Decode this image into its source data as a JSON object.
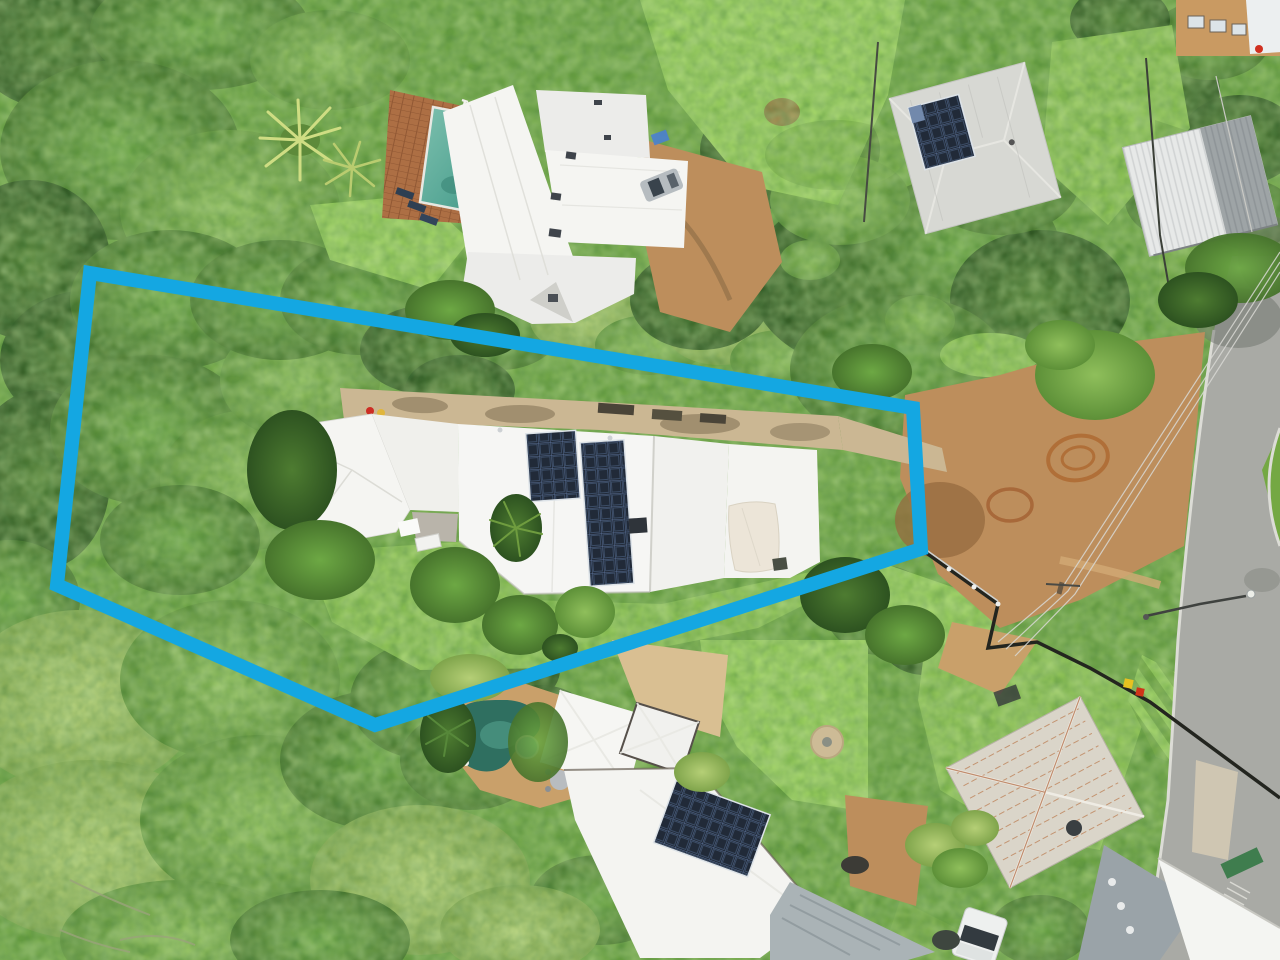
{
  "image": {
    "kind": "aerial-drone-photograph",
    "description": "Top-down aerial photo of a suburban bush block; a long irregular lot outlined with a thick blue boundary highlight contains a white-roofed house with rooftop solar, a concrete driveway and lawn surrounded by dense tree canopy; neighbouring houses with pools, solar panels, a rusty-roofed cottage, a curving street, power lines and cleared red-dirt ground are visible.",
    "width_px": 1280,
    "height_px": 960,
    "visible_text": ""
  },
  "boundary": {
    "points": "90,273 913,408 921,549 375,725 57,585",
    "color": "#14a7e2",
    "stroke_width": 14
  },
  "palette": {
    "boundary": "#14a7e2",
    "canopy_base": "#69a03f",
    "canopy_dark": "#3c6527",
    "canopy_mid": "#5d9038",
    "canopy_light": "#8fbf5b",
    "canopy_yellow": "#a9c86d",
    "lawn": "#8cc152",
    "lawn_bright": "#97cd5a",
    "lawn_dark": "#74a843",
    "roof_white": "#f5f5f2",
    "roof_weathered": "#d7d8d3",
    "roof_rust_base": "#dad5c9",
    "rust": "#b2602a",
    "solar_dark": "#212a38",
    "solar_light": "#51709f",
    "pool_top": "#5aa795",
    "pool_bottom": "#2f6f60",
    "spa": "#8ecbd6",
    "deck_brick": "#ad6f44",
    "paving_tan": "#c9a06a",
    "driveway": "#cbb793",
    "dirt": "#bd8e5c",
    "dirt_dark": "#96693f",
    "road": "#a9aaa5",
    "curb": "#dcdcd6",
    "fence_dark": "#23251f",
    "shade_sail": "#ece5d8",
    "vehicle_white": "#eef0ef",
    "vehicle_gray": "#b6bcc0"
  },
  "scene": {
    "objects": [
      {
        "name": "boundary-highlight",
        "label": "blue highlighted lot boundary polygon"
      },
      {
        "name": "subject-house",
        "label": "white-roofed house inside boundary with two rooftop solar arrays"
      },
      {
        "name": "subject-driveway",
        "label": "long concrete driveway along north side of lot"
      },
      {
        "name": "subject-backyard-lawn",
        "label": "lawn south of subject house"
      },
      {
        "name": "shade-sail",
        "label": "cream shade sail on east wing"
      },
      {
        "name": "neighbor-north-house",
        "label": "white multi-section roof house north of lot"
      },
      {
        "name": "neighbor-north-pool",
        "label": "teal rectangular swimming pool with brick deck"
      },
      {
        "name": "neighbor-northeast-house",
        "label": "weathered hip-roof house with solar panels"
      },
      {
        "name": "neighbor-northeast-carport",
        "label": "corrugated metal carport/shed"
      },
      {
        "name": "street-corner-building",
        "label": "tan building at top right corner"
      },
      {
        "name": "road",
        "label": "curving asphalt street on right"
      },
      {
        "name": "cleared-dirt-area",
        "label": "graded red-dirt clearing with circular marks"
      },
      {
        "name": "power-pole",
        "label": "timber power pole with crossarm"
      },
      {
        "name": "power-lines",
        "label": "overhead wires crossing the clearing"
      },
      {
        "name": "street-light",
        "label": "street light arm over road"
      },
      {
        "name": "boundary-fence",
        "label": "dark fence with white posts along south-east lot edge"
      },
      {
        "name": "neighbor-south-house",
        "label": "white pyramid-roof house with solar array and kidney pool"
      },
      {
        "name": "neighbor-south-pool",
        "label": "dark teal kidney-shaped pool with spa"
      },
      {
        "name": "neighbor-southeast-rusty-roof-house",
        "label": "silver cottage roof streaked with rust, satellite dish"
      },
      {
        "name": "white-ute",
        "label": "white utility vehicle parked at bottom right"
      },
      {
        "name": "tree-canopy",
        "label": "dense green tree canopy over left half of frame"
      },
      {
        "name": "palm-trees",
        "label": "fan palms near pools and gardens"
      },
      {
        "name": "mow-striped-verge",
        "label": "mow-striped grass verge beside road"
      },
      {
        "name": "wheelie-bins",
        "label": "red and yellow bins beside driveway"
      },
      {
        "name": "silver-car",
        "label": "silver vehicle beside north house"
      }
    ]
  }
}
